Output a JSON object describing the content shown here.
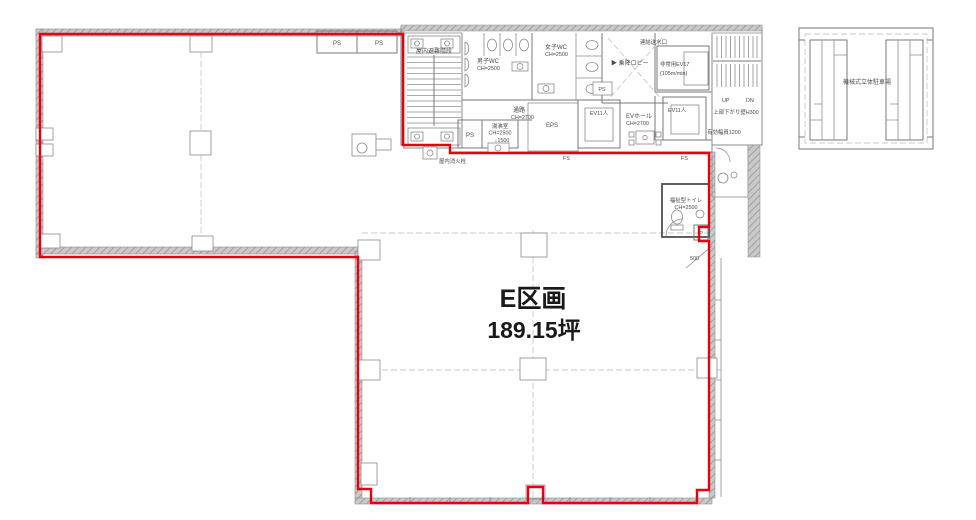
{
  "section": {
    "name": "E区画",
    "area": "189.15坪"
  },
  "parking": {
    "label": "機械式立体駐車場"
  },
  "core": {
    "stairs": "屋内避難階段",
    "mens_wc": {
      "name": "男子WC",
      "ch": "CH=2500"
    },
    "womens_wc": {
      "name": "女子WC",
      "ch": "CH=2500"
    },
    "lobby": "▶ 乗降ロビー",
    "standpipe": "連結送水口",
    "emergency_ev": {
      "name": "非常用EV17",
      "speed": "(105m/min)"
    },
    "corridor": {
      "name": "通路",
      "ch": "CH=2700"
    },
    "kitchenette": {
      "name": "湯沸室",
      "ch": "CH=2500",
      "note": "↓1500"
    },
    "eps": "EPS",
    "ev_a": "EV11人",
    "ev_b": "EV11人",
    "ev_hall": {
      "name": "EVホール",
      "ch": "CH=2700"
    },
    "right_stair": {
      "up": "UP",
      "dn": "DN",
      "note1": "上部下がり壁H300",
      "note2": "有効幅員1200"
    },
    "hydrant": "屋内消火栓",
    "ps1": "PS",
    "ps2": "PS",
    "ps3": "PS",
    "ps4": "PS",
    "fs1": "FS",
    "fs2": "FS"
  },
  "accessible_wc": {
    "name": "福祉型トイレ",
    "ch": "CH=2500",
    "p": "P",
    "dim": "500"
  },
  "colors": {
    "boundary": "#e60012"
  }
}
